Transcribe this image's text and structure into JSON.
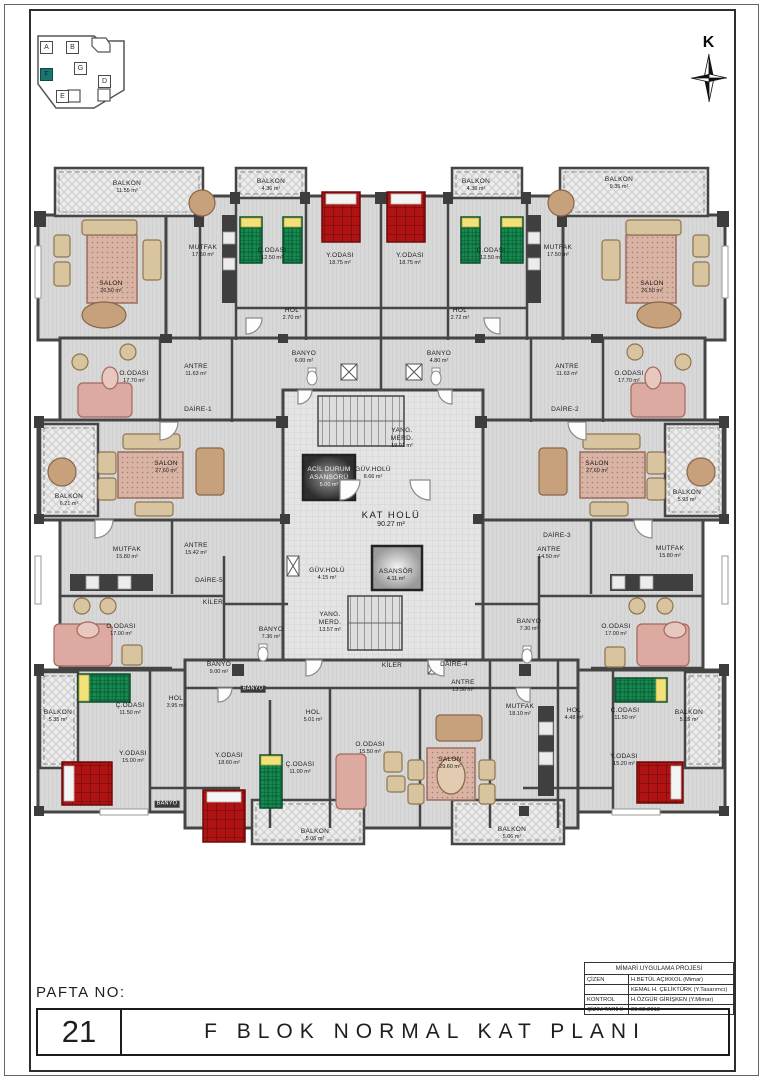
{
  "meta": {
    "sheet_no_label": "PAFTA NO:",
    "sheet_no": "21",
    "title": "F BLOK NORMAL KAT PLANI"
  },
  "north": {
    "label": "K"
  },
  "colors": {
    "accent": "#1a7470",
    "bed_red": "#b01313",
    "bed_green": "#15894f",
    "wall": "#454545"
  },
  "keyplan": {
    "active_block": "F",
    "blocks": [
      {
        "label": "A",
        "x": 10,
        "y": 9
      },
      {
        "label": "B",
        "x": 36,
        "y": 9
      },
      {
        "label": "F",
        "x": 10,
        "y": 36,
        "active": true
      },
      {
        "label": "G",
        "x": 44,
        "y": 30
      },
      {
        "label": "D",
        "x": 68,
        "y": 43
      },
      {
        "label": "E",
        "x": 26,
        "y": 58
      }
    ]
  },
  "titleblock": {
    "header": "MİMARİ UYGULAMA PROJESİ",
    "rows": [
      {
        "label": "ÇİZEN",
        "value": "H.BETÜL AÇIKKOL (Mimar)"
      },
      {
        "label": "",
        "value": "KEMAL H. ÇELİKTÜRK (Y.Tasarımcı)"
      },
      {
        "label": "KONTROL",
        "value": "H.ÖZGÜR GİRİŞKEN (Y.Mimar)"
      },
      {
        "label": "ÇİZİM TARİHİ",
        "value": "23.02.2012"
      }
    ]
  },
  "plan": {
    "rooms": [
      {
        "label": "BALKON",
        "area": "11.55 m²",
        "x": 127,
        "y": 187
      },
      {
        "label": "BALKON",
        "area": "4.36 m²",
        "x": 271,
        "y": 185
      },
      {
        "label": "BALKON",
        "area": "4.36 m²",
        "x": 476,
        "y": 185
      },
      {
        "label": "BALKON",
        "area": "9.35 m²",
        "x": 619,
        "y": 183
      },
      {
        "label": "MUTFAK",
        "area": "17.50 m²",
        "x": 203,
        "y": 251
      },
      {
        "label": "Ç.ODASI",
        "area": "12.50 m²",
        "x": 272,
        "y": 254
      },
      {
        "label": "Y.ODASI",
        "area": "18.75 m²",
        "x": 340,
        "y": 259
      },
      {
        "label": "Y.ODASI",
        "area": "18.75 m²",
        "x": 410,
        "y": 259
      },
      {
        "label": "Ç.ODASI",
        "area": "12.50 m²",
        "x": 491,
        "y": 254
      },
      {
        "label": "MUTFAK",
        "area": "17.50 m²",
        "x": 558,
        "y": 251
      },
      {
        "label": "SALON",
        "area": "26.50 m²",
        "x": 111,
        "y": 287
      },
      {
        "label": "SALON",
        "area": "26.50 m²",
        "x": 652,
        "y": 287
      },
      {
        "label": "HOL",
        "area": "2.70 m²",
        "x": 292,
        "y": 314
      },
      {
        "label": "HOL",
        "area": "2.72 m²",
        "x": 460,
        "y": 314
      },
      {
        "label": "BANYO",
        "area": "6.00 m²",
        "x": 304,
        "y": 357
      },
      {
        "label": "BANYO",
        "area": "4.80 m²",
        "x": 439,
        "y": 357
      },
      {
        "label": "O.ODASI",
        "area": "17.70 m²",
        "x": 134,
        "y": 377
      },
      {
        "label": "ANTRE",
        "area": "11.63 m²",
        "x": 196,
        "y": 370
      },
      {
        "label": "DAİRE-1",
        "area": "",
        "x": 198,
        "y": 410
      },
      {
        "label": "ANTRE",
        "area": "11.63 m²",
        "x": 567,
        "y": 370
      },
      {
        "label": "O.ODASI",
        "area": "17.70 m²",
        "x": 629,
        "y": 377
      },
      {
        "label": "DAİRE-2",
        "area": "",
        "x": 565,
        "y": 410
      },
      {
        "label": "YANG. MERD.",
        "area": "19.01 m²",
        "x": 402,
        "y": 438,
        "cls": "wrap"
      },
      {
        "label": "GÜV.HOLÜ",
        "area": "8.66 m²",
        "x": 373,
        "y": 473
      },
      {
        "label": "ACİL DURUM ASANSÖRÜ",
        "area": "5.00 m²",
        "x": 329,
        "y": 477,
        "cls": "ondark"
      },
      {
        "label": "KAT HOLÜ",
        "area": "90.27 m²",
        "x": 391,
        "y": 520,
        "cls": "lg"
      },
      {
        "label": "BALKON",
        "area": "6.21 m²",
        "x": 69,
        "y": 500
      },
      {
        "label": "SALON",
        "area": "27.60 m²",
        "x": 166,
        "y": 467
      },
      {
        "label": "SALON",
        "area": "27.60 m²",
        "x": 597,
        "y": 467
      },
      {
        "label": "BALKON",
        "area": "5.93 m²",
        "x": 687,
        "y": 496
      },
      {
        "label": "MUTFAK",
        "area": "15.80 m²",
        "x": 127,
        "y": 553
      },
      {
        "label": "ANTRE",
        "area": "15.42 m²",
        "x": 196,
        "y": 549
      },
      {
        "label": "DAİRE-5",
        "area": "",
        "x": 209,
        "y": 581
      },
      {
        "label": "DAİRE-3",
        "area": "",
        "x": 557,
        "y": 536
      },
      {
        "label": "ANTRE",
        "area": "14.50 m²",
        "x": 549,
        "y": 553
      },
      {
        "label": "MUTFAK",
        "area": "15.80 m²",
        "x": 670,
        "y": 552
      },
      {
        "label": "GÜV.HOLÜ",
        "area": "4.15 m²",
        "x": 327,
        "y": 574
      },
      {
        "label": "ASANSÖR",
        "area": "4.11 m²",
        "x": 396,
        "y": 575
      },
      {
        "label": "YANG. MERD.",
        "area": "13.57 m²",
        "x": 330,
        "y": 622,
        "cls": "wrap"
      },
      {
        "label": "KİLER",
        "area": "",
        "x": 213,
        "y": 603
      },
      {
        "label": "BANYO",
        "area": "7.36 m²",
        "x": 271,
        "y": 633
      },
      {
        "label": "O.ODASI",
        "area": "17.00 m²",
        "x": 121,
        "y": 630
      },
      {
        "label": "BANYO",
        "area": "9.00 m²",
        "x": 219,
        "y": 668
      },
      {
        "label": "BANYO",
        "area": "",
        "x": 253,
        "y": 689,
        "cls": "dark"
      },
      {
        "label": "BANYO",
        "area": "7.30 m²",
        "x": 529,
        "y": 625
      },
      {
        "label": "O.ODASI",
        "area": "17.00 m²",
        "x": 616,
        "y": 630
      },
      {
        "label": "KİLER",
        "area": "",
        "x": 392,
        "y": 666
      },
      {
        "label": "DAİRE-4",
        "area": "",
        "x": 454,
        "y": 665
      },
      {
        "label": "ANTRE",
        "area": "13.30 m²",
        "x": 463,
        "y": 686
      },
      {
        "label": "Ç.ODASI",
        "area": "11.50 m²",
        "x": 130,
        "y": 709
      },
      {
        "label": "HOL",
        "area": "3.95 m²",
        "x": 176,
        "y": 702
      },
      {
        "label": "BALKON",
        "area": "5.35 m²",
        "x": 58,
        "y": 716
      },
      {
        "label": "Y.ODASI",
        "area": "15.00 m²",
        "x": 133,
        "y": 757
      },
      {
        "label": "BANYO",
        "area": "",
        "x": 167,
        "y": 804,
        "cls": "dark"
      },
      {
        "label": "Y.ODASI",
        "area": "18.60 m²",
        "x": 229,
        "y": 759
      },
      {
        "label": "HOL",
        "area": "5.01 m²",
        "x": 313,
        "y": 716
      },
      {
        "label": "Ç.ODASI",
        "area": "11.00 m²",
        "x": 300,
        "y": 768
      },
      {
        "label": "O.ODASI",
        "area": "15.50 m²",
        "x": 370,
        "y": 748
      },
      {
        "label": "SALON",
        "area": "29.60 m²",
        "x": 450,
        "y": 763
      },
      {
        "label": "MUTFAK",
        "area": "18.10 m²",
        "x": 520,
        "y": 710
      },
      {
        "label": "HOL",
        "area": "4.48 m²",
        "x": 574,
        "y": 714
      },
      {
        "label": "Ç.ODASI",
        "area": "11.50 m²",
        "x": 625,
        "y": 714
      },
      {
        "label": "BALKON",
        "area": "5.15 m²",
        "x": 689,
        "y": 716
      },
      {
        "label": "Y.ODASI",
        "area": "15.20 m²",
        "x": 624,
        "y": 760
      },
      {
        "label": "BALKON",
        "area": "5.06 m²",
        "x": 315,
        "y": 835
      },
      {
        "label": "BALKON",
        "area": "5.06 m²",
        "x": 512,
        "y": 833
      }
    ]
  }
}
